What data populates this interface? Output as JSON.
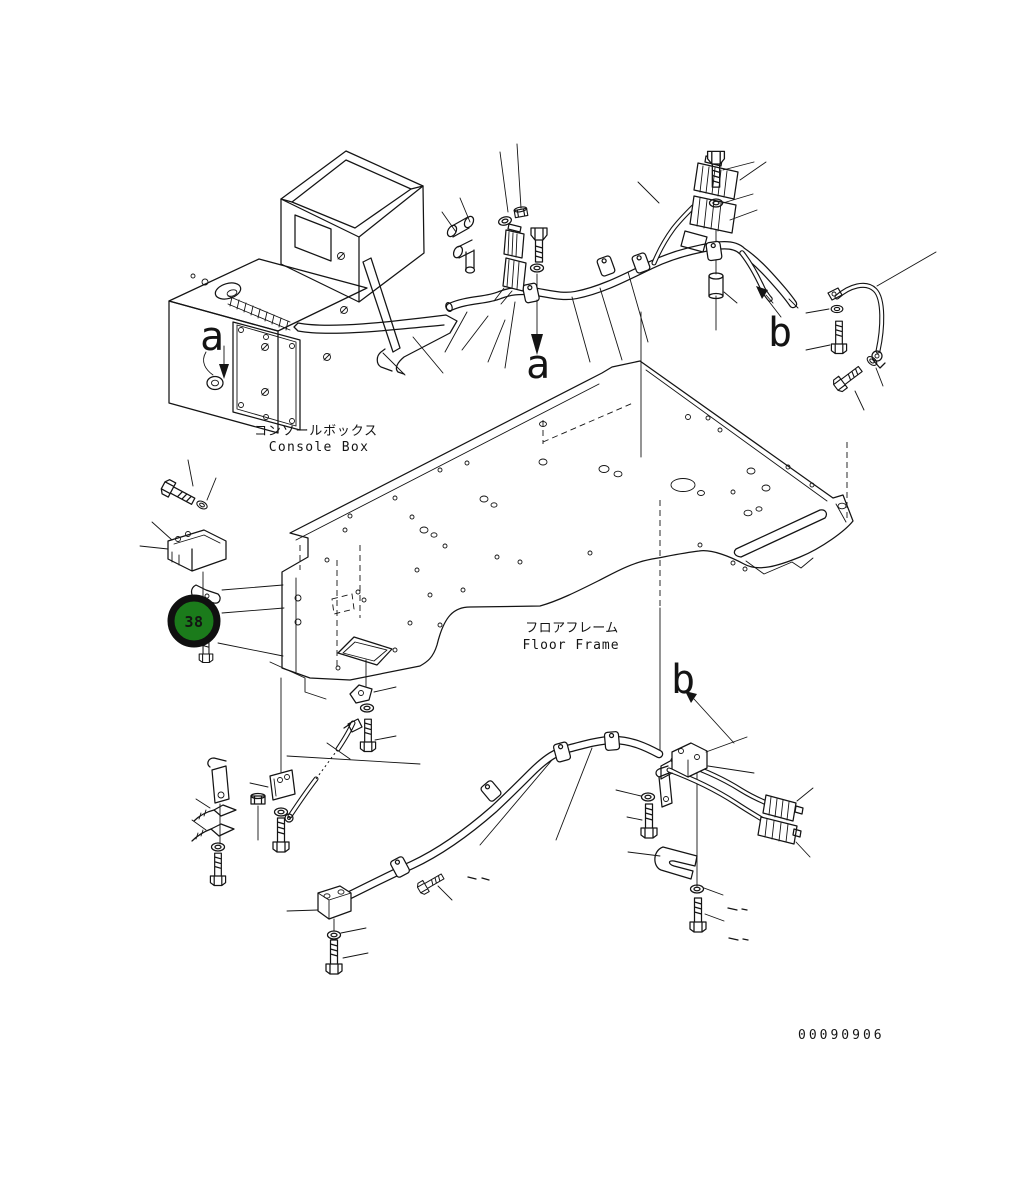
{
  "document": {
    "background": "#ffffff",
    "line_color": "#141414"
  },
  "labels": {
    "console_box_jp": "コンソールボックス",
    "console_box_en": "Console Box",
    "floor_frame_jp": "フロアフレーム",
    "floor_frame_en": "Floor Frame",
    "console_view_a": "a",
    "harness_view_a": "a",
    "upper_view_b": "b",
    "lower_view_b": "b"
  },
  "balloon": {
    "number": "38",
    "fill": "#1b7b1b",
    "ring": "#101010",
    "text_color": "#ffffff"
  },
  "footer": {
    "drawing_number": "00090906"
  }
}
